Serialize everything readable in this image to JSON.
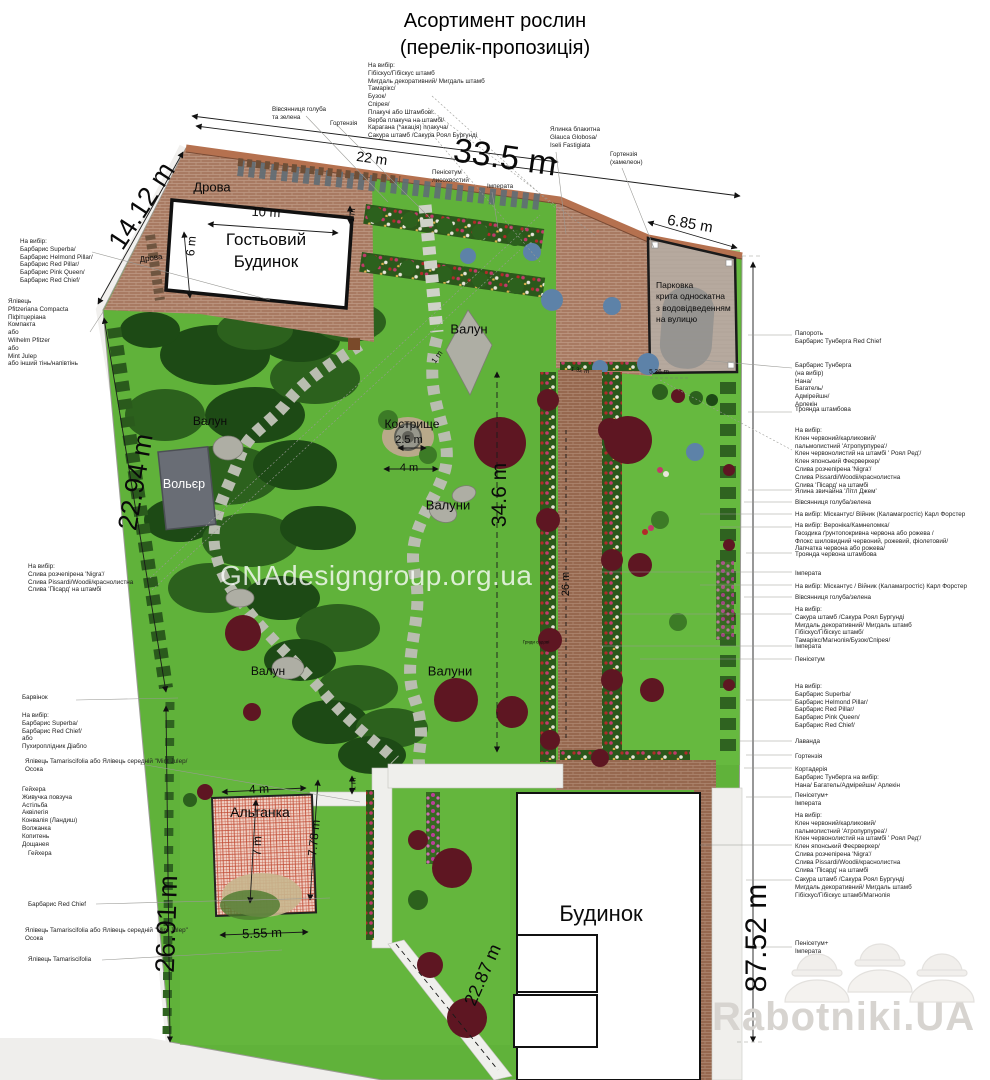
{
  "title": "Асортимент рослин\n(перелік-пропозиція)",
  "watermark": "GNAdesigngroup.org.ua",
  "brand": "Rabotniki.UA",
  "features": {
    "guest_house": "Гостьовий\nБудинок",
    "house": "Будинок",
    "parking": "Парковка\nкрита односкатна\nз водовідведенням\nна вулицю",
    "gazebo": "Альтанка",
    "aviary": "Вольєр",
    "firewood": "Дрова",
    "firewood2": "Дрова",
    "boulder1": "Валун",
    "boulder2": "Валун",
    "boulder3": "Валун",
    "boulders1": "Валуни",
    "boulders2": "Валуни",
    "firepit": "Кострище",
    "garden_beds": "Гряди садові"
  },
  "dims": {
    "top": "33.5 m",
    "top_sub": "22 m",
    "diag": "14.12 m",
    "left1": "22.94 m",
    "left2": "26.91 m",
    "right": "87.52 m",
    "center": "34.6 m",
    "path": "26 m",
    "bottom": "22.87 m",
    "parking": "6.85 m",
    "guest_w": "10 m",
    "guest_h": "6 m",
    "guest_off": "1 m",
    "path_w": "1 m",
    "gaz_off": "1 m",
    "firepit_d": "2.5 m",
    "firepit_w": "4 m",
    "gaz_w": "4 m",
    "gaz_h": "7 m",
    "gaz_h2": "7.78 m",
    "gaz_w2": "5.55 m",
    "m132": "1.32 m",
    "m536": "5.36 m"
  },
  "plants": {
    "top_list": "На вибір:\nГібіскус/Гібіскус штамб\nМигдаль декоративний/ Мигдаль штамб\nТамарікс/\nБузок/\nСпірея/\nПлакучі або Штамбові:\nВерба плакуча на штамбі/\nКарагана (*акація) плакуча/\nСакура штамб /Сакура Роял Бургунді",
    "fescue": "Вівсянниця голуба\nта зелена",
    "hydrangea": "Гортензія",
    "pennisetum": "Пенісетум\nлисохвостий",
    "imperata": "Імперата",
    "spruce": "Ялинка блакитна\nGlauca Globosa/\nIseli Fastigiata",
    "hydrangea2": "Гортензія\n(хамелеон)",
    "left": [
      "На вибір:\nБарбарис Superba/\nБарбарис Helmond Pillar/\nБарбарис Red Pillar/\nБарбарис Pink Queen/\nБарбарис Red Chief/",
      "Ялівець\nPfitzeriana Compacta\nПіфітцеріана\nКомпакта\nабо\nWilhelm Pfitzer\nабо\nMint Julep\nабо інший тінь/напівтінь",
      "На вибір:\nСлива розчепірена 'Nigra'/\nСлива Pissardi/Woodii/краснолистна\nСлива 'Пісард' на штамбі",
      "Барвінок",
      "На вибір:\nБарбарис Superba/\nБарбарис Red Chief/\nабо\nПухироплідник Діабло",
      "Ялівець Tamariscifolia або Ялівець середній \"Mint Julep/\nОсока",
      "Гейхера\nЖивучка повзуча\nАстільба\nАквілегія\nКонвалія (Ландиш)\nВолжанка\nКопитень\nДощанея",
      "Гейхера",
      "Барбарис Red Chief",
      "Ялівець Tamariscifolia або Ялівець середній \"Mint Julep\"\nОсока",
      "Ялівець Tamariscifolia"
    ],
    "right": [
      "Папороть\nБарбарис Тунберга Red Chief",
      "Барбарис Тунберга\n(на вибір)\nНана/\nБагатель/\nАдмірейшн/\nАрлекін",
      "Троянда штамбова",
      "На вибір:\nКлен червоний/карликовий/\nпальмолистний 'Атропурпуреа'/\nКлен червонолистий на штамбі ' Роял Ред'/\nКлен японський Феєрверкер/\nСлива розчепірена 'Nigra'/\nСлива Pissardi/Woodii/краснолистна\nСлива 'Пісард' на штамбі",
      "Ялина звичайна 'Літл Джем'",
      "Вівсянниця голуба/зелена",
      "На вибір: Міскантус/ Війник (Каламагростіс) Карл Форстер",
      "На вибір: Вероніка/Камнеломка/\nГвоздика ґрунтопокривна червона або рожева /\nФлокс шиловидний червоний, рожевий, фіолетовий/\nЛапчатка червона або рожева/",
      "Троянда червона штамбова",
      "Імперата",
      "На вибір: Міскантус / Війник (Каламагростіс) Карл Форстер",
      "Вівсянниця голуба/зелена",
      "На вибір:\nСакура штамб /Сакура Роял Бургунді\nМигдаль декоративний/ Мигдаль штамб\nГібіскус/Гібіскус штамб/\nТамарікс/Магнолія/Бузок/Спірея/",
      "Імперата",
      "Пенісетум",
      "На вибір:\nБарбарис Superba/\nБарбарис Helmond Pillar/\nБарбарис Red Pillar/\nБарбарис Pink Queen/\nБарбарис Red Chief/",
      "Лаванда",
      "Гортензія",
      "Кортадерія",
      "Барбарис Тунберга на вибір:\nНана/ Багатель/Адмірейшн/ Арлекін",
      "Пенісетум+\nІмперата",
      "На вибір:\nКлен червоний/карликовий/\nпальмолистний 'Атропурпуреа'/\nКлен червонолистий на штамбі ' Роял Ред'/\nКлен японський Феєрверкер/\nСлива розчепірена 'Nigra'/\nСлива Pissardi/Woodii/краснолистна\nСлива 'Пісард' на штамбі",
      "Сакура штамб /Сакура Роял Бургунді\nМигдаль декоративний/ Мигдаль штамб\nГібіскус/Гібіскус штамб/Магнолія",
      "Пенісетум+\nІмперата"
    ]
  }
}
